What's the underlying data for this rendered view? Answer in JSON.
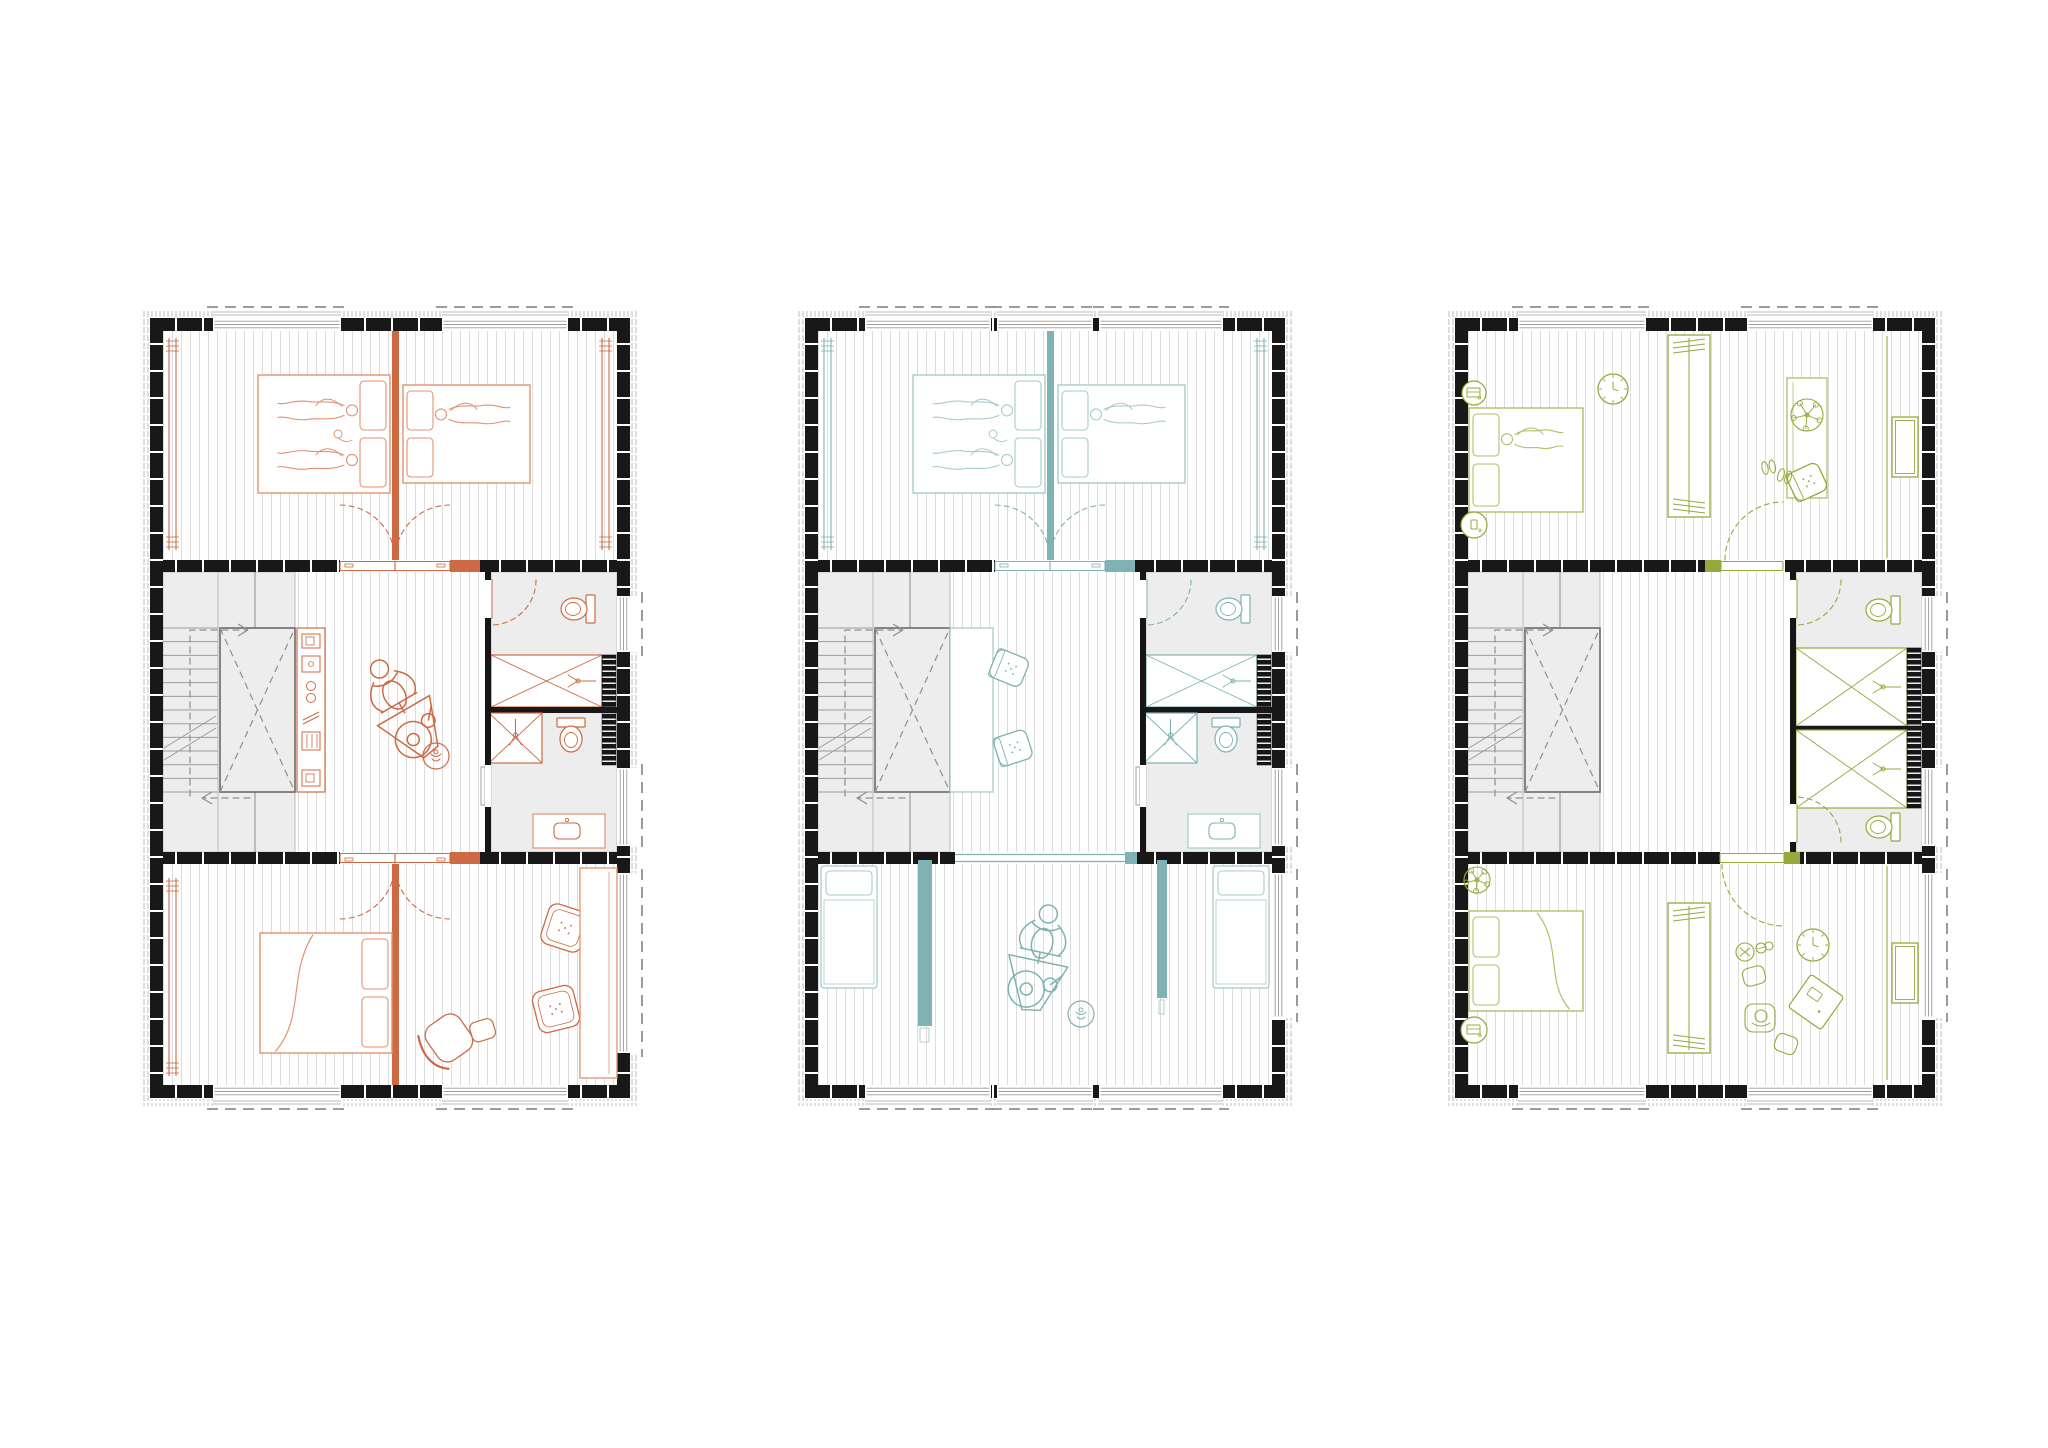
{
  "document": {
    "title": "Residential floor plan — three furnishing variants",
    "type": "architectural-floor-plan",
    "background": "#ffffff"
  },
  "shared": {
    "wall_color": "#181818",
    "floor_hatch_color": "#DCDCDC",
    "zone_fill": "#EDEDED",
    "zone_edge": "#C4C4C4",
    "stair_line": "#9B9B9B",
    "dash_color": "#8F8F8F",
    "window_frame": "#9A9A9A",
    "tick_color": "#ADADAD"
  },
  "plans": [
    {
      "key": "p1",
      "name": "variant-orange-two-kids-rooms-master-suite",
      "accent": "#CE6A43",
      "accent_light": "#E2926F",
      "position": {
        "x": 150,
        "y": 318
      },
      "structure": {
        "top_windows": [
          [
            63,
            191
          ],
          [
            292,
            418
          ]
        ],
        "bottom_windows": [
          [
            63,
            191
          ],
          [
            292,
            418
          ]
        ],
        "right_windows": [
          [
            278,
            334
          ],
          [
            450,
            528
          ],
          [
            555,
            735
          ]
        ],
        "top_divider": true,
        "bottom_divider": true,
        "wall1_opening": [
          190,
          300
        ],
        "wall1_door": "double-up",
        "wall1_accent": [
          300,
          330
        ],
        "wall2_opening": [
          190,
          300
        ],
        "wall2_door": "double-down",
        "wall2_accent": [
          300,
          330
        ],
        "bathroom": "A"
      },
      "furniture": [
        {
          "type": "track",
          "x": 19,
          "y": 20,
          "h": 212
        },
        {
          "type": "track",
          "x": 452,
          "y": 20,
          "h": 212
        },
        {
          "type": "bed-double",
          "x": 108,
          "y": 57,
          "w": 132,
          "h": 118,
          "pillows": "right",
          "figures": 2,
          "baby": true
        },
        {
          "type": "bed-double",
          "x": 253,
          "y": 67,
          "w": 127,
          "h": 98,
          "pillows": "left",
          "figures": 1
        },
        {
          "type": "shelf-unit",
          "x": 147,
          "y": 310,
          "w": 28,
          "h": 164
        },
        {
          "type": "exercise-bike",
          "x": 252,
          "y": 390,
          "rot": -30,
          "scale": 1.5
        },
        {
          "type": "pouf",
          "x": 286,
          "y": 438,
          "r": 13
        },
        {
          "type": "track",
          "x": 19,
          "y": 560,
          "h": 198
        },
        {
          "type": "bed-double",
          "x": 110,
          "y": 615,
          "w": 132,
          "h": 120,
          "pillows": "right"
        },
        {
          "type": "lounge-chair",
          "x": 300,
          "y": 718,
          "rot": -35
        },
        {
          "type": "cushion",
          "x": 415,
          "y": 610,
          "rot": 18
        },
        {
          "type": "cushion",
          "x": 406,
          "y": 691,
          "rot": -14
        },
        {
          "type": "counter",
          "x": 430,
          "y": 550,
          "w": 37,
          "h": 210
        }
      ]
    },
    {
      "key": "p2",
      "name": "variant-teal-shared-kids-room",
      "accent": "#7FB2B2",
      "accent_light": "#A7CBCB",
      "position": {
        "x": 805,
        "y": 318
      },
      "structure": {
        "top_windows": [
          [
            60,
            186
          ],
          [
            192,
            288
          ],
          [
            294,
            418
          ]
        ],
        "bottom_windows": [
          [
            60,
            186
          ],
          [
            192,
            288
          ],
          [
            294,
            418
          ]
        ],
        "right_windows": [
          [
            278,
            334
          ],
          [
            450,
            528
          ],
          [
            555,
            700
          ]
        ],
        "top_divider": true,
        "bottom_divider": false,
        "wall1_opening": [
          190,
          300
        ],
        "wall1_door": "double-up",
        "wall1_accent": [
          300,
          330
        ],
        "wall2_opening": [
          150,
          320
        ],
        "wall2_door": "wide",
        "wall2_accent": [
          318,
          332
        ],
        "bathroom": "A"
      },
      "furniture": [
        {
          "type": "track",
          "x": 19,
          "y": 20,
          "h": 212
        },
        {
          "type": "track",
          "x": 452,
          "y": 20,
          "h": 212
        },
        {
          "type": "bed-double",
          "x": 108,
          "y": 57,
          "w": 132,
          "h": 118,
          "pillows": "right",
          "figures": 2,
          "baby": true
        },
        {
          "type": "bed-double",
          "x": 253,
          "y": 67,
          "w": 127,
          "h": 98,
          "pillows": "left",
          "figures": 1
        },
        {
          "type": "desk-table",
          "x": 145,
          "y": 310,
          "w": 43,
          "h": 164
        },
        {
          "type": "desk-chair",
          "x": 204,
          "y": 350,
          "rot": 22
        },
        {
          "type": "desk-chair",
          "x": 208,
          "y": 430,
          "rot": -18
        },
        {
          "type": "bed-single",
          "x": 16,
          "y": 548,
          "w": 56,
          "h": 122
        },
        {
          "type": "bed-single",
          "x": 408,
          "y": 548,
          "w": 56,
          "h": 122
        },
        {
          "type": "partition",
          "x": 113,
          "y": 542,
          "w": 14,
          "h": 166
        },
        {
          "type": "partition",
          "x": 352,
          "y": 542,
          "w": 10,
          "h": 138
        },
        {
          "type": "exercise-bike",
          "x": 234,
          "y": 640,
          "rot": 12,
          "scale": 1.5
        },
        {
          "type": "pouf",
          "x": 276,
          "y": 696,
          "r": 13
        }
      ]
    },
    {
      "key": "p3",
      "name": "variant-green-open-studio-rooms",
      "accent": "#94A93B",
      "accent_light": "#AFC06A",
      "position": {
        "x": 1455,
        "y": 318
      },
      "structure": {
        "top_windows": [
          [
            63,
            191
          ],
          [
            292,
            418
          ]
        ],
        "bottom_windows": [
          [
            63,
            191
          ],
          [
            292,
            418
          ]
        ],
        "right_windows": [
          [
            278,
            334
          ],
          [
            450,
            528
          ],
          [
            555,
            700
          ]
        ],
        "top_divider": false,
        "bottom_divider": false,
        "wall1_opening": [
          266,
          330
        ],
        "wall1_door": "single-up",
        "wall1_accent": [
          250,
          266
        ],
        "wall2_opening": [
          265,
          329
        ],
        "wall2_door": "single-down",
        "wall2_accent": [
          329,
          345
        ],
        "bathroom": "B"
      },
      "furniture": [
        {
          "type": "table-round",
          "x": 19,
          "y": 75,
          "r": 12,
          "item": "laptop"
        },
        {
          "type": "bed-double",
          "x": 14,
          "y": 90,
          "w": 114,
          "h": 104,
          "pillows": "left",
          "figures": 1
        },
        {
          "type": "table-round",
          "x": 19,
          "y": 207,
          "r": 13,
          "item": "phone"
        },
        {
          "type": "clock",
          "x": 158,
          "y": 71,
          "r": 15
        },
        {
          "type": "wardrobe",
          "x": 213,
          "y": 17,
          "w": 42,
          "h": 182
        },
        {
          "type": "wall-line",
          "x": 432,
          "y": 18,
          "h": 222
        },
        {
          "type": "desk-v",
          "x": 332,
          "y": 60,
          "w": 40,
          "h": 120
        },
        {
          "type": "plant",
          "x": 352,
          "y": 97,
          "r": 16
        },
        {
          "type": "desk-chair",
          "x": 352,
          "y": 164,
          "rot": -25
        },
        {
          "type": "shoes",
          "x": 310,
          "y": 150
        },
        {
          "type": "wall-shelf",
          "x": 437,
          "y": 99,
          "w": 26,
          "h": 60
        },
        {
          "type": "plant",
          "x": 22,
          "y": 562,
          "r": 13
        },
        {
          "type": "bed-double",
          "x": 14,
          "y": 593,
          "w": 114,
          "h": 100,
          "pillows": "left"
        },
        {
          "type": "table-round",
          "x": 19,
          "y": 712,
          "r": 13,
          "item": "laptop"
        },
        {
          "type": "wardrobe",
          "x": 213,
          "y": 585,
          "w": 42,
          "h": 150
        },
        {
          "type": "wall-line",
          "x": 432,
          "y": 548,
          "h": 214
        },
        {
          "type": "toy",
          "x": 300,
          "y": 631
        },
        {
          "type": "clock",
          "x": 358,
          "y": 627,
          "r": 16
        },
        {
          "type": "sitting-group",
          "x": 361,
          "y": 684,
          "rot": 35
        },
        {
          "type": "wall-shelf",
          "x": 437,
          "y": 625,
          "w": 26,
          "h": 60
        }
      ]
    }
  ]
}
